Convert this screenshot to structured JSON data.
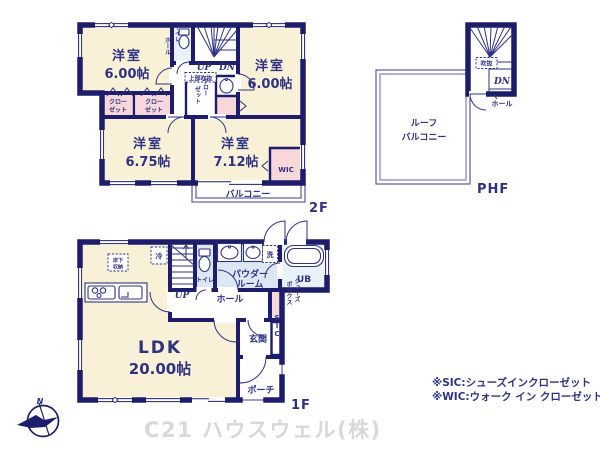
{
  "colors": {
    "wall_navy": "#1d1d6b",
    "text_navy": "#2e3282",
    "room_cream": "#f9f1d7",
    "closet_pink": "#f7d7d9",
    "wet_blue": "#dbe8f4",
    "bath_blue": "#e9f1f9",
    "rail_blue": "#6466a8",
    "logo_gray": "#d8d8d8"
  },
  "floor2": {
    "label": "2F",
    "rooms": [
      {
        "name": "洋室",
        "size": "6.00帖"
      },
      {
        "name": "洋室",
        "size": "6.00帖"
      },
      {
        "name": "洋室",
        "size": "6.75帖"
      },
      {
        "name": "洋室",
        "size": "7.12帖"
      }
    ],
    "wic": "WIC",
    "closet": {
      "line1": "クロー",
      "line2": "ゼット"
    },
    "hall": "ホール",
    "toilet": "トイレ",
    "up": "UP",
    "dn": "DN",
    "joubu_fukinuke": "上部吹抜",
    "balcony": "バルコニー"
  },
  "phf": {
    "label": "PHF",
    "fukinuke": "吹抜",
    "dn": "DN",
    "hall": "ホール",
    "roof1": "ルーフ",
    "roof2": "バルコニー"
  },
  "floor1": {
    "label": "1F",
    "ldk_name": "LDK",
    "ldk_size": "20.00帖",
    "fridge": "冷",
    "underfloor1": "床下",
    "underfloor2": "収納",
    "up": "UP",
    "toilet": "トイレ",
    "powder1": "パウダー",
    "powder2": "ルーム",
    "laundry": "洗",
    "ub": "UB",
    "hall": "ホール",
    "shoes1": "シューズ",
    "shoes2": "ボックス",
    "genkan": "玄関",
    "sic": "SIC",
    "porch": "ポーチ"
  },
  "notes": {
    "sic": "※SIC:シューズインクローゼット",
    "wic": "※WIC:ウォーク イン クローゼット"
  },
  "branding": {
    "company": "C21 ハウスウェル(株)",
    "north": "N"
  }
}
